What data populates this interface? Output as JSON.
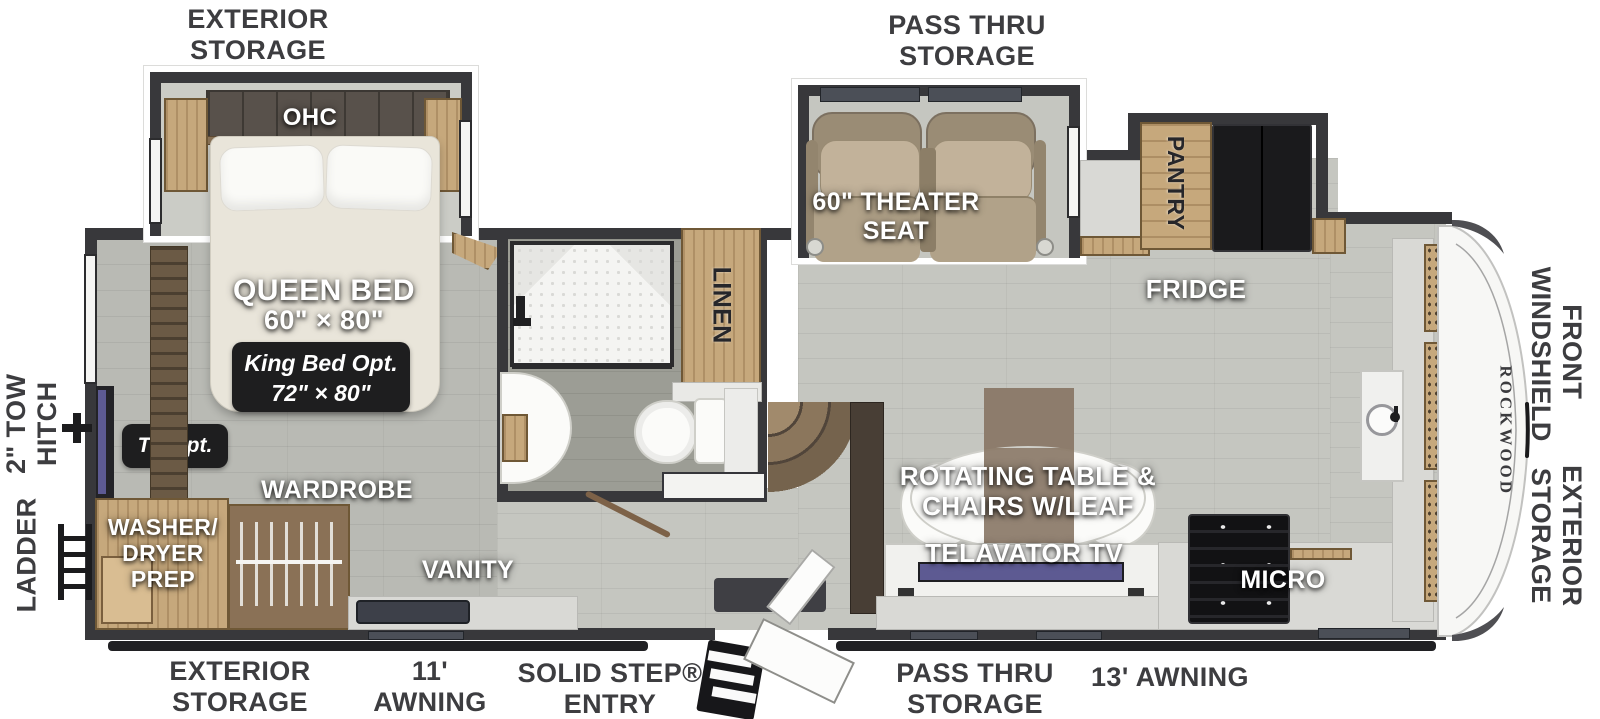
{
  "brand": {
    "name": "ROCKWOOD"
  },
  "colors": {
    "wall": "#38383b",
    "wood": "#c6a87c",
    "floor_living": "#c5c6c0",
    "floor_bedroom": "#b9bab4",
    "floor_bath": "#9c9d95",
    "badge_bg": "#1e1e1f",
    "label_dark": "#3d3d40",
    "fridge": "#1a1a1c",
    "tv_screen": "#5d5a92",
    "theater_seat": "#b1a289"
  },
  "exterior_labels": {
    "top_storage": "EXTERIOR\nSTORAGE",
    "top_pass_thru": "PASS THRU\nSTORAGE",
    "bottom_storage": "EXTERIOR\nSTORAGE",
    "awning_11": "11'\nAWNING",
    "solid_step": "SOLID STEP®\nENTRY",
    "bottom_pass_thru": "PASS THRU\nSTORAGE",
    "awning_13": "13' AWNING",
    "front_windshield": "FRONT\nWINDSHIELD",
    "front_storage": "EXTERIOR\nSTORAGE",
    "tow_hitch": "2\" TOW\nHITCH",
    "ladder": "LADDER"
  },
  "bedroom": {
    "ohc": "OHC",
    "bed": "QUEEN BED",
    "bed_size": "60\" × 80\"",
    "king_opt": "King Bed Opt.\n72\" × 80\"",
    "tv_opt": "TV Opt.",
    "wardrobe": "WARDROBE",
    "washer_dryer": "WASHER/\nDRYER\nPREP",
    "vanity": "VANITY"
  },
  "bathroom": {
    "linen": "LINEN"
  },
  "living": {
    "theater": "60\" THEATER\nSEAT",
    "pantry": "PANTRY",
    "fridge": "FRIDGE",
    "table": "ROTATING TABLE &\nCHAIRS W/LEAF",
    "tv": "TELAVATOR TV",
    "micro": "MICRO",
    "ohc": "OHC"
  }
}
